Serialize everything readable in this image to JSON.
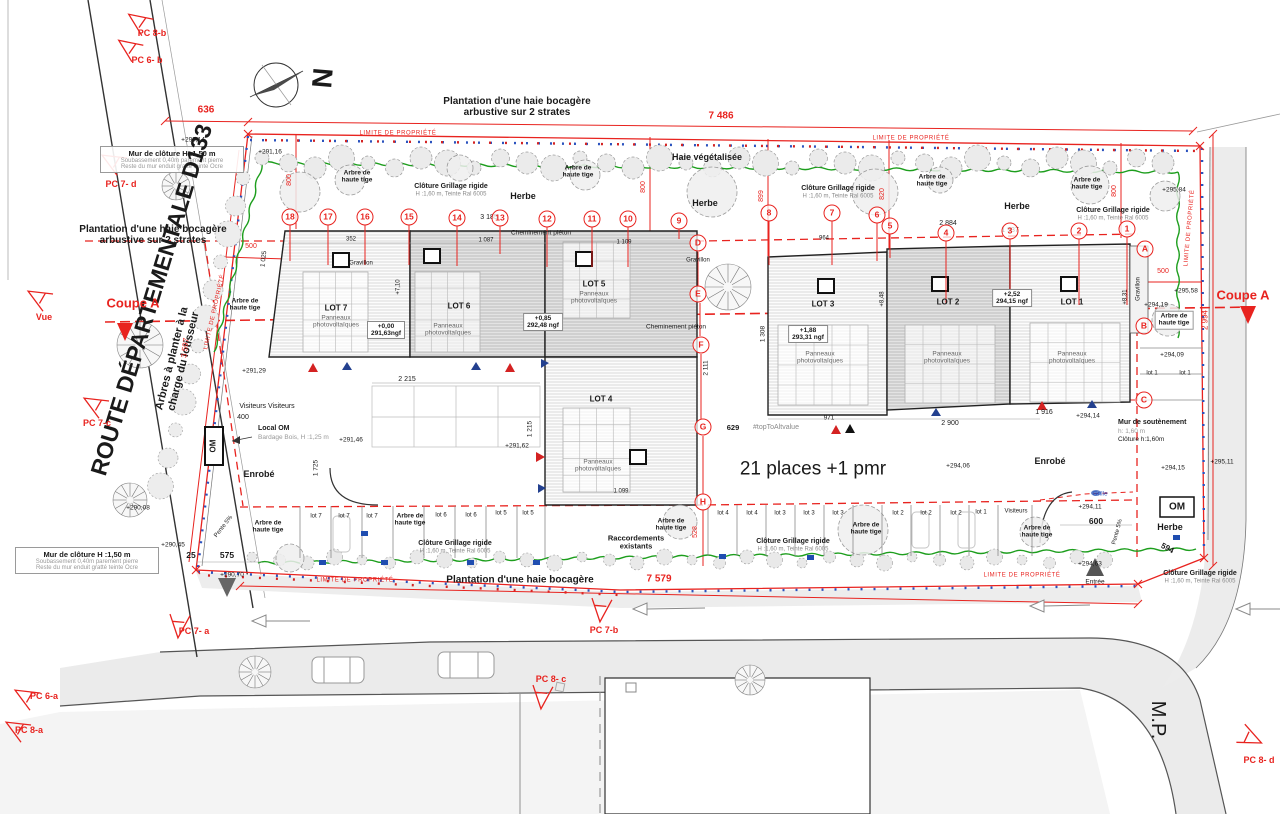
{
  "compass": {
    "north": "N"
  },
  "lots": [
    {
      "name": "LOT 1",
      "panels": "Panneaux\nphotovoltaïques"
    },
    {
      "name": "LOT 2",
      "panels": "Panneaux\nphotovoltaïques"
    },
    {
      "name": "LOT 3",
      "panels": "Panneaux\nphotovoltaïques"
    },
    {
      "name": "LOT 4",
      "panels": "Panneaux\nphotovoltaïques"
    },
    {
      "name": "LOT 5",
      "panels": "Panneaux\nphotovoltaïques"
    },
    {
      "name": "LOT 6",
      "panels": "Panneaux\nphotovoltaïques"
    },
    {
      "name": "LOT 7",
      "panels": "Panneaux\nphotovoltaïques"
    }
  ],
  "value_boxes": [
    {
      "v": "+0,00",
      "ngf": "291,63ngf"
    },
    {
      "v": "+0,85",
      "ngf": "292,48 ngf"
    },
    {
      "v": "+1,88",
      "ngf": "293,31 ngf"
    },
    {
      "v": "+2,52",
      "ngf": "294,15 ngf"
    }
  ],
  "wall_note": {
    "title": "Mur de clôture H :1,50 m",
    "line1": "Soubassement 0,40m parement pierre",
    "line2": "Reste du mur enduit gratté teinte Ocre"
  },
  "retaining_note": {
    "l1": "Mur de soutènement",
    "l2": "h: 1,60 m",
    "l3": "Clôture h:1,60m"
  },
  "local_om": {
    "l1": "Local OM",
    "l2": "Bardage Bois, H :1,25 m"
  },
  "om_label": "OM",
  "badges_numbers": [
    {
      "t": "18",
      "x": 290,
      "y": 217,
      "l": 36
    },
    {
      "t": "17",
      "x": 328,
      "y": 217,
      "l": 40
    },
    {
      "t": "16",
      "x": 365,
      "y": 217,
      "l": 40
    },
    {
      "t": "15",
      "x": 409,
      "y": 217,
      "l": 40
    },
    {
      "t": "14",
      "x": 457,
      "y": 218,
      "l": 40
    },
    {
      "t": "13",
      "x": 500,
      "y": 218,
      "l": 28
    },
    {
      "t": "12",
      "x": 547,
      "y": 219,
      "l": 40
    },
    {
      "t": "11",
      "x": 592,
      "y": 219,
      "l": 40
    },
    {
      "t": "10",
      "x": 628,
      "y": 219,
      "l": 40
    },
    {
      "t": "9",
      "x": 679,
      "y": 221,
      "l": 10
    },
    {
      "t": "8",
      "x": 769,
      "y": 213,
      "l": 44
    },
    {
      "t": "7",
      "x": 832,
      "y": 213,
      "l": 44
    },
    {
      "t": "6",
      "x": 877,
      "y": 215,
      "l": 38
    },
    {
      "t": "5",
      "x": 890,
      "y": 226,
      "l": 24
    },
    {
      "t": "4",
      "x": 946,
      "y": 233,
      "l": 62
    },
    {
      "t": "3",
      "x": 1010,
      "y": 231,
      "l": 66
    },
    {
      "t": "2",
      "x": 1079,
      "y": 231,
      "l": 66
    },
    {
      "t": "1",
      "x": 1127,
      "y": 229,
      "l": 68
    }
  ],
  "badges_letters": [
    {
      "t": "D",
      "x": 698,
      "y": 243
    },
    {
      "t": "E",
      "x": 698,
      "y": 294
    },
    {
      "t": "F",
      "x": 701,
      "y": 345
    },
    {
      "t": "G",
      "x": 703,
      "y": 427
    },
    {
      "t": "H",
      "x": 703,
      "y": 502
    },
    {
      "t": "A",
      "x": 1145,
      "y": 249
    },
    {
      "t": "B",
      "x": 1144,
      "y": 326
    },
    {
      "t": "C",
      "x": 1144,
      "y": 400
    }
  ],
  "annotations": [
    {
      "t": "Plantation d'une haie bocagère\narbustive sur 2 strates",
      "x": 517,
      "y": 107,
      "s": 10,
      "c": "b",
      "n": "plantation-note-top"
    },
    {
      "t": "Plantation d'une haie bocagère\narbustive sur 2 strates",
      "x": 153,
      "y": 235,
      "s": 10,
      "c": "b",
      "n": "plantation-note-west"
    },
    {
      "t": "Plantation d'une haie bocagère",
      "x": 520,
      "y": 580,
      "s": 10,
      "c": "b",
      "n": "plantation-note-south"
    },
    {
      "t": "Haie végétalisée",
      "x": 707,
      "y": 157,
      "s": 9,
      "c": "b",
      "n": "hedge-label"
    },
    {
      "t": "ROUTE DÉPARTEMENTALE D133",
      "x": 152,
      "y": 300,
      "s": 23,
      "c": "b",
      "r": -73,
      "n": "road-name"
    },
    {
      "t": "Arbres à planter à la\ncharge du lotisseur",
      "x": 178,
      "y": 360,
      "s": 11,
      "c": "b",
      "r": -76,
      "n": "trees-note"
    },
    {
      "t": "21 places +1 pmr",
      "x": 813,
      "y": 469,
      "s": 19,
      "n": "parking-count"
    },
    {
      "t": "M.P.",
      "x": 1158,
      "y": 720,
      "s": 20,
      "r": 90,
      "n": "mp-road-label"
    },
    {
      "t": "Entrée",
      "x": 1095,
      "y": 582,
      "s": 6.5,
      "n": "entrance-label"
    },
    {
      "t": "Coupe A",
      "x": 133,
      "y": 304,
      "s": 13,
      "c": "b red",
      "n": "section-a-left"
    },
    {
      "t": "Coupe A",
      "x": 1243,
      "y": 296,
      "s": 13,
      "c": "b red",
      "n": "section-a-right"
    },
    {
      "t": "Vue",
      "x": 44,
      "y": 317,
      "s": 9,
      "c": "b red",
      "n": "vue-marker-label"
    },
    {
      "t": "N",
      "x": 322,
      "y": 78,
      "s": 28,
      "c": "b",
      "r": 95,
      "n": "north-letter"
    },
    {
      "t": "Herbe",
      "x": 523,
      "y": 196,
      "s": 9,
      "c": "b"
    },
    {
      "t": "Herbe",
      "x": 705,
      "y": 203,
      "s": 9,
      "c": "b"
    },
    {
      "t": "Herbe",
      "x": 1017,
      "y": 206,
      "s": 9,
      "c": "b"
    },
    {
      "t": "Herbe",
      "x": 1170,
      "y": 527,
      "s": 9,
      "c": "b"
    },
    {
      "t": "Enrobé",
      "x": 259,
      "y": 474,
      "s": 9,
      "c": "b"
    },
    {
      "t": "Enrobé",
      "x": 1050,
      "y": 461,
      "s": 9,
      "c": "b"
    },
    {
      "t": "Cheminement piéton",
      "x": 541,
      "y": 233,
      "s": 6.5
    },
    {
      "t": "Cheminement piéton",
      "x": 676,
      "y": 327,
      "s": 6.5
    },
    {
      "t": "Raccordements\nexistants",
      "x": 636,
      "y": 543,
      "s": 7.5,
      "c": "b"
    },
    {
      "t": "Arbre de\nhaute tige",
      "x": 357,
      "y": 177,
      "s": 6.5,
      "c": "b"
    },
    {
      "t": "Arbre de\nhaute tige",
      "x": 578,
      "y": 172,
      "s": 6.5,
      "c": "b"
    },
    {
      "t": "Arbre de\nhaute tige",
      "x": 932,
      "y": 181,
      "s": 6.5,
      "c": "b"
    },
    {
      "t": "Arbre de\nhaute tige",
      "x": 1087,
      "y": 184,
      "s": 6.5,
      "c": "b"
    },
    {
      "t": "Arbre de\nhaute tige",
      "x": 245,
      "y": 305,
      "s": 6.5,
      "c": "b"
    },
    {
      "t": "Arbre de\nhaute tige",
      "x": 1174,
      "y": 320,
      "s": 6.5,
      "c": "b bg"
    },
    {
      "t": "Arbre de\nhaute tige",
      "x": 268,
      "y": 527,
      "s": 6.5,
      "c": "b"
    },
    {
      "t": "Arbre de\nhaute tige",
      "x": 410,
      "y": 520,
      "s": 6.5,
      "c": "b"
    },
    {
      "t": "Arbre de\nhaute tige",
      "x": 671,
      "y": 525,
      "s": 6.5,
      "c": "b"
    },
    {
      "t": "Arbre de\nhaute tige",
      "x": 866,
      "y": 529,
      "s": 6.5,
      "c": "b"
    },
    {
      "t": "Arbre de\nhaute tige",
      "x": 1037,
      "y": 532,
      "s": 6.5,
      "c": "b"
    },
    {
      "t": "Clôture Grillage rigide",
      "x": 451,
      "y": 187,
      "s": 7,
      "c": "b"
    },
    {
      "t": "H :1,60 m, Teinte Ral 6005",
      "x": 451,
      "y": 195,
      "s": 6,
      "c": "gray"
    },
    {
      "t": "Clôture Grillage rigide",
      "x": 838,
      "y": 189,
      "s": 7,
      "c": "b"
    },
    {
      "t": "H :1,60 m, Teinte Ral 6005",
      "x": 838,
      "y": 197,
      "s": 6,
      "c": "gray"
    },
    {
      "t": "Clôture Grillage rigide",
      "x": 1113,
      "y": 211,
      "s": 7,
      "c": "b"
    },
    {
      "t": "H :1,60 m, Teinte Ral 6005",
      "x": 1113,
      "y": 219,
      "s": 6,
      "c": "gray"
    },
    {
      "t": "Clôture Grillage rigide",
      "x": 455,
      "y": 544,
      "s": 7,
      "c": "b"
    },
    {
      "t": "H :1,60 m, Teinte Ral 6005",
      "x": 455,
      "y": 552,
      "s": 6,
      "c": "gray"
    },
    {
      "t": "Clôture Grillage rigide",
      "x": 793,
      "y": 542,
      "s": 7,
      "c": "b"
    },
    {
      "t": "H :1,60 m, Teinte Ral 6005",
      "x": 793,
      "y": 550,
      "s": 6,
      "c": "gray"
    },
    {
      "t": "Clôture Grillage rigide",
      "x": 1200,
      "y": 574,
      "s": 7,
      "c": "b"
    },
    {
      "t": "H :1,60 m, Teinte Ral 6005",
      "x": 1200,
      "y": 582,
      "s": 6,
      "c": "gray"
    },
    {
      "t": "Visiteurs Visiteurs",
      "x": 267,
      "y": 407,
      "s": 7
    },
    {
      "t": "400",
      "x": 243,
      "y": 418,
      "s": 7
    },
    {
      "t": "Visiteurs",
      "x": 1016,
      "y": 512,
      "s": 6
    },
    {
      "t": "Grille",
      "x": 1100,
      "y": 494,
      "s": 6.5,
      "c": "blue"
    },
    {
      "t": "Gravillon",
      "x": 361,
      "y": 264,
      "s": 6
    },
    {
      "t": "Gravillon",
      "x": 698,
      "y": 261,
      "s": 6
    },
    {
      "t": "Gravillon",
      "x": 1139,
      "y": 289,
      "s": 6,
      "r": -90
    },
    {
      "t": "Pente 5%",
      "x": 224,
      "y": 527,
      "s": 6,
      "r": -52
    },
    {
      "t": "Pente 5%",
      "x": 1118,
      "y": 532,
      "s": 6,
      "r": -75
    },
    {
      "t": "#topToAltvalue",
      "x": 776,
      "y": 428,
      "s": 7,
      "c": "gray"
    },
    {
      "t": "629",
      "x": 733,
      "y": 428,
      "s": 7.5,
      "c": "b"
    },
    {
      "t": "636",
      "x": 206,
      "y": 110,
      "s": 10,
      "c": "b red"
    },
    {
      "t": "7 486",
      "x": 721,
      "y": 116,
      "s": 10,
      "c": "b red"
    },
    {
      "t": "7 579",
      "x": 659,
      "y": 579,
      "s": 10,
      "c": "b red"
    },
    {
      "t": "800",
      "x": 290,
      "y": 180,
      "s": 7,
      "c": "red",
      "r": -90
    },
    {
      "t": "800",
      "x": 644,
      "y": 187,
      "s": 7,
      "c": "red",
      "r": -90
    },
    {
      "t": "899",
      "x": 762,
      "y": 196,
      "s": 7,
      "c": "red",
      "r": -90
    },
    {
      "t": "820",
      "x": 883,
      "y": 194,
      "s": 7,
      "c": "red",
      "r": -90
    },
    {
      "t": "800",
      "x": 1115,
      "y": 191,
      "s": 7,
      "c": "red",
      "r": -90
    },
    {
      "t": "500",
      "x": 251,
      "y": 247,
      "s": 7,
      "c": "red"
    },
    {
      "t": "500",
      "x": 1163,
      "y": 272,
      "s": 7,
      "c": "red"
    },
    {
      "t": "2 994",
      "x": 1206,
      "y": 320,
      "s": 8,
      "c": "red",
      "r": -90
    },
    {
      "t": "3 597",
      "x": 186,
      "y": 348,
      "s": 8,
      "c": "red",
      "r": -83
    },
    {
      "t": "528",
      "x": 696,
      "y": 532,
      "s": 7,
      "c": "red",
      "r": -90
    },
    {
      "t": "LIMITE DE PROPRIÉTÉ",
      "x": 398,
      "y": 134,
      "s": 6,
      "c": "lim"
    },
    {
      "t": "LIMITE DE PROPRIÉTÉ",
      "x": 911,
      "y": 139,
      "s": 6,
      "c": "lim"
    },
    {
      "t": "LIMITE DE PROPRIÉTÉ",
      "x": 1190,
      "y": 228,
      "s": 6,
      "c": "lim",
      "r": -85
    },
    {
      "t": "LIMITE DE PROPRIÉTÉ",
      "x": 215,
      "y": 312,
      "s": 6,
      "c": "lim",
      "r": -77
    },
    {
      "t": "LIMITE DE PROPRIÉTÉ",
      "x": 355,
      "y": 581,
      "s": 6,
      "c": "lim"
    },
    {
      "t": "LIMITE DE PROPRIÉTÉ",
      "x": 1022,
      "y": 576,
      "s": 6,
      "c": "lim"
    },
    {
      "t": "3 185",
      "x": 489,
      "y": 218,
      "s": 7
    },
    {
      "t": "352",
      "x": 351,
      "y": 240,
      "s": 6
    },
    {
      "t": "1 087",
      "x": 486,
      "y": 241,
      "s": 6
    },
    {
      "t": "1 109",
      "x": 624,
      "y": 243,
      "s": 6
    },
    {
      "t": "2 884",
      "x": 948,
      "y": 224,
      "s": 7
    },
    {
      "t": "1 937",
      "x": 1010,
      "y": 231,
      "s": 7
    },
    {
      "t": "964",
      "x": 824,
      "y": 239,
      "s": 6
    },
    {
      "t": "2 215",
      "x": 407,
      "y": 380,
      "s": 7
    },
    {
      "t": "2 900",
      "x": 950,
      "y": 424,
      "s": 7
    },
    {
      "t": "1 916",
      "x": 1044,
      "y": 413,
      "s": 7
    },
    {
      "t": "971",
      "x": 829,
      "y": 418,
      "s": 6.5
    },
    {
      "t": "600",
      "x": 1096,
      "y": 522,
      "s": 8.5,
      "c": "b"
    },
    {
      "t": "575",
      "x": 227,
      "y": 556,
      "s": 8.5,
      "c": "b"
    },
    {
      "t": "25",
      "x": 191,
      "y": 556,
      "s": 8.5,
      "c": "b"
    },
    {
      "t": "594",
      "x": 1167,
      "y": 549,
      "s": 8,
      "c": "b",
      "r": 28
    },
    {
      "t": "1 099",
      "x": 621,
      "y": 492,
      "s": 6
    },
    {
      "t": "1 025",
      "x": 264,
      "y": 259,
      "s": 6.5,
      "r": -83
    },
    {
      "t": "1 725",
      "x": 316,
      "y": 468,
      "s": 6.5,
      "r": -90
    },
    {
      "t": "1 215",
      "x": 530,
      "y": 429,
      "s": 6.5,
      "r": -90
    },
    {
      "t": "1 308",
      "x": 763,
      "y": 334,
      "s": 6.5,
      "r": -90
    },
    {
      "t": "2 111",
      "x": 706,
      "y": 368,
      "s": 6.5,
      "r": -90
    },
    {
      "t": "+7,10",
      "x": 399,
      "y": 287,
      "s": 6,
      "r": -90
    },
    {
      "t": "+8,48",
      "x": 883,
      "y": 299,
      "s": 6,
      "r": -90
    },
    {
      "t": "+8,31",
      "x": 1126,
      "y": 297,
      "s": 6,
      "r": -90
    },
    {
      "t": "+290,14",
      "x": 193,
      "y": 140,
      "s": 6.5
    },
    {
      "t": "+291,16",
      "x": 270,
      "y": 152,
      "s": 6.5
    },
    {
      "t": "+295,84",
      "x": 1174,
      "y": 190,
      "s": 6.5
    },
    {
      "t": "+295,58",
      "x": 1186,
      "y": 291,
      "s": 6.5
    },
    {
      "t": "+294,19",
      "x": 1156,
      "y": 305,
      "s": 6.5
    },
    {
      "t": "+294,09",
      "x": 1172,
      "y": 355,
      "s": 6.5
    },
    {
      "t": "+291,29",
      "x": 254,
      "y": 371,
      "s": 6.5
    },
    {
      "t": "+291,46",
      "x": 351,
      "y": 440,
      "s": 6.5
    },
    {
      "t": "+291,62",
      "x": 517,
      "y": 446,
      "s": 6.5
    },
    {
      "t": "+294,06",
      "x": 958,
      "y": 466,
      "s": 6.5
    },
    {
      "t": "+294,15",
      "x": 1173,
      "y": 468,
      "s": 6.5
    },
    {
      "t": "+295,11",
      "x": 1222,
      "y": 462,
      "s": 6.5
    },
    {
      "t": "+294,11",
      "x": 1090,
      "y": 507,
      "s": 6.5
    },
    {
      "t": "+294,14",
      "x": 1088,
      "y": 416,
      "s": 6.5
    },
    {
      "t": "+290,08",
      "x": 138,
      "y": 508,
      "s": 6.5
    },
    {
      "t": "+290,45",
      "x": 173,
      "y": 545,
      "s": 6.5
    },
    {
      "t": "+290,70",
      "x": 232,
      "y": 575,
      "s": 6.5
    },
    {
      "t": "+294,63",
      "x": 1090,
      "y": 564,
      "s": 6.5
    },
    {
      "t": "lot 7",
      "x": 316,
      "y": 517,
      "s": 6
    },
    {
      "t": "lot 7",
      "x": 344,
      "y": 517,
      "s": 6
    },
    {
      "t": "lot 7",
      "x": 372,
      "y": 517,
      "s": 6
    },
    {
      "t": "lot 6",
      "x": 441,
      "y": 516,
      "s": 6
    },
    {
      "t": "lot 6",
      "x": 471,
      "y": 516,
      "s": 6
    },
    {
      "t": "lot 5",
      "x": 501,
      "y": 514,
      "s": 6
    },
    {
      "t": "lot 5",
      "x": 528,
      "y": 514,
      "s": 6
    },
    {
      "t": "lot 4",
      "x": 723,
      "y": 514,
      "s": 6
    },
    {
      "t": "lot 4",
      "x": 752,
      "y": 514,
      "s": 6
    },
    {
      "t": "lot 3",
      "x": 780,
      "y": 514,
      "s": 6
    },
    {
      "t": "lot 3",
      "x": 809,
      "y": 514,
      "s": 6
    },
    {
      "t": "lot 3",
      "x": 838,
      "y": 514,
      "s": 6
    },
    {
      "t": "lot 2",
      "x": 898,
      "y": 514,
      "s": 6
    },
    {
      "t": "lot 2",
      "x": 926,
      "y": 514,
      "s": 6
    },
    {
      "t": "lot 2",
      "x": 956,
      "y": 514,
      "s": 6
    },
    {
      "t": "lot 1",
      "x": 981,
      "y": 513,
      "s": 6
    },
    {
      "t": "lot 1",
      "x": 1152,
      "y": 374,
      "s": 6
    },
    {
      "t": "lot 1",
      "x": 1185,
      "y": 374,
      "s": 6
    },
    {
      "t": "PC 8-b",
      "x": 152,
      "y": 33,
      "s": 9,
      "c": "b red",
      "n": "pc-8b"
    },
    {
      "t": "PC 6- b",
      "x": 147,
      "y": 60,
      "s": 9,
      "c": "b red",
      "n": "pc-6b"
    },
    {
      "t": "PC 7- d",
      "x": 121,
      "y": 184,
      "s": 9,
      "c": "b red",
      "n": "pc-7d"
    },
    {
      "t": "PC 7-c",
      "x": 97,
      "y": 423,
      "s": 9,
      "c": "b red",
      "n": "pc-7c"
    },
    {
      "t": "PC 6-a",
      "x": 44,
      "y": 696,
      "s": 9,
      "c": "b red",
      "n": "pc-6a"
    },
    {
      "t": "PC 8-a",
      "x": 29,
      "y": 730,
      "s": 9,
      "c": "b red",
      "n": "pc-8a"
    },
    {
      "t": "PC 7- a",
      "x": 194,
      "y": 631,
      "s": 9,
      "c": "b red",
      "n": "pc-7a"
    },
    {
      "t": "PC 7-b",
      "x": 604,
      "y": 630,
      "s": 9,
      "c": "b red",
      "n": "pc-7b"
    },
    {
      "t": "PC 8- c",
      "x": 551,
      "y": 679,
      "s": 9,
      "c": "b red",
      "n": "pc-8c"
    },
    {
      "t": "PC 8- d",
      "x": 1259,
      "y": 760,
      "s": 9,
      "c": "b red",
      "n": "pc-8d"
    }
  ]
}
